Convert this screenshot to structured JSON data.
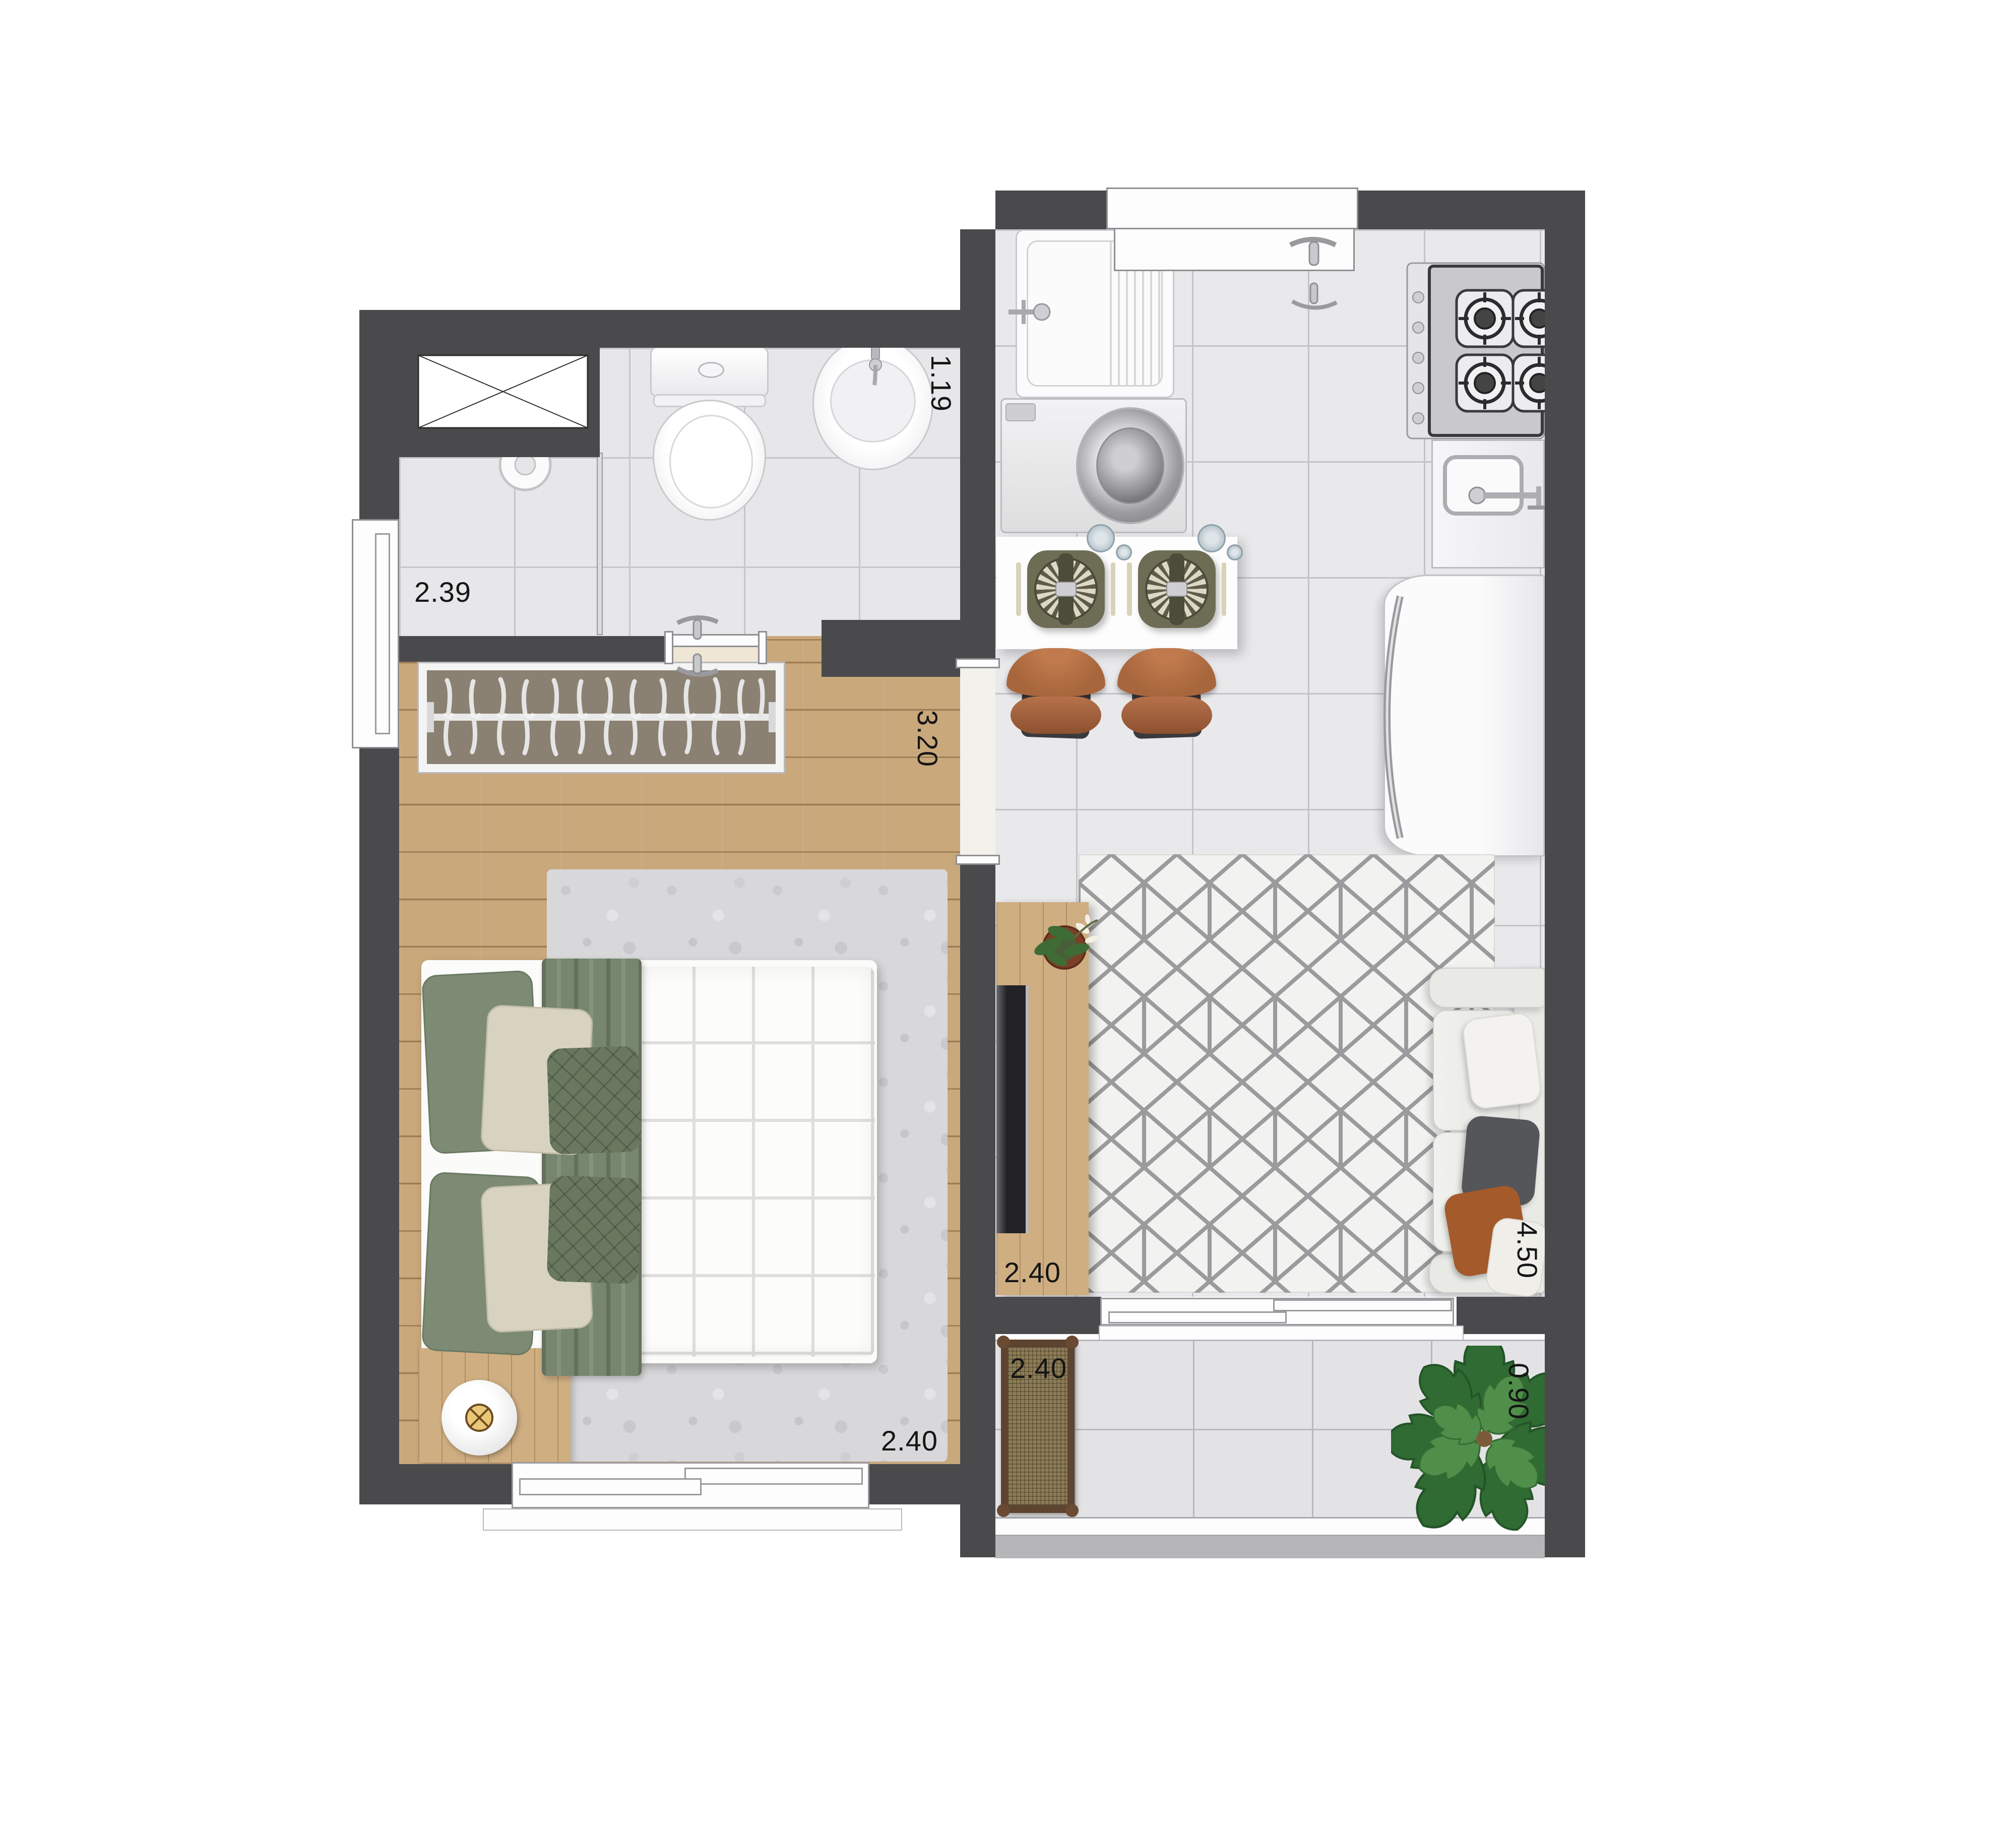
{
  "plan": {
    "type": "apartment-floor-plan",
    "dimension_labels": {
      "shower_width": {
        "text": "2.39",
        "orientation": "horizontal"
      },
      "bathroom_depth": {
        "text": "1.19",
        "orientation": "vertical"
      },
      "hall_depth": {
        "text": "3.20",
        "orientation": "vertical"
      },
      "bedroom_width": {
        "text": "2.40",
        "orientation": "horizontal"
      },
      "living_width": {
        "text": "2.40",
        "orientation": "horizontal"
      },
      "living_depth": {
        "text": "4.50",
        "orientation": "vertical"
      },
      "balcony_width": {
        "text": "2.40",
        "orientation": "horizontal"
      },
      "balcony_depth": {
        "text": "0.90",
        "orientation": "vertical"
      }
    },
    "colors": {
      "wall": "#4a4a4c",
      "tile_floor": "#e9e9ec",
      "wood_floor": "#c9a87c",
      "balcony_ledge": "#b6b6b8",
      "bedding_green": "#7d8b74",
      "chair_leather": "#a8663c",
      "plant_green": "#3e7a3e",
      "label_text": "#151515"
    },
    "furniture_icons": [
      "shaft-icon",
      "shower-head-icon",
      "toilet-icon",
      "washbasin-icon",
      "laundry-tub-icon",
      "washing-machine-icon",
      "window-icon",
      "stove-icon",
      "kitchen-sink-icon",
      "fridge-icon",
      "dining-table-icon",
      "dining-chair-icon",
      "tv-console-icon",
      "tv-icon",
      "potted-plant-icon",
      "rug-icon",
      "sofa-icon",
      "sliding-door-icon",
      "wardrobe-icon",
      "bed-icon",
      "nightstand-icon",
      "lamp-icon",
      "bench-icon",
      "monstera-plant-icon"
    ]
  }
}
